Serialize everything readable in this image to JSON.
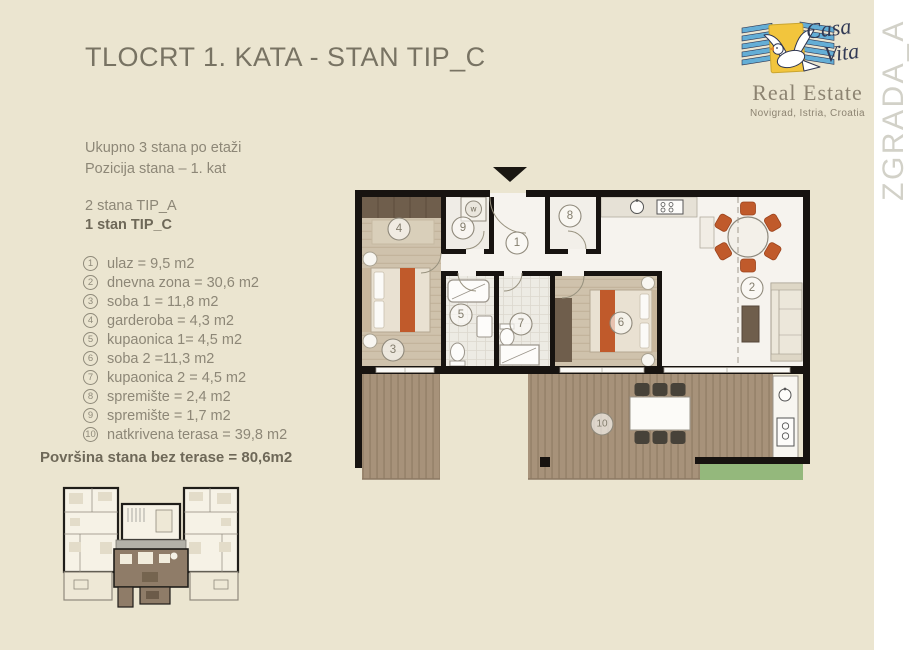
{
  "header": {
    "title": "TLOCRT 1. KATA - STAN TIP_C"
  },
  "side_label": {
    "text": "ZGRADA_A"
  },
  "logo": {
    "script1": "Casa",
    "script2": "Vita",
    "subtitle": "Real Estate",
    "location": "Novigrad, Istria, Croatia"
  },
  "info": {
    "total_per_floor": "Ukupno 3 stana po etaži",
    "position": "Pozicija stana – 1. kat",
    "type_a": "2 stana TIP_A",
    "type_c": "1 stan TIP_C"
  },
  "rooms": [
    {
      "num": "1",
      "label": "ulaz = 9,5 m2"
    },
    {
      "num": "2",
      "label": "dnevna zona = 30,6 m2"
    },
    {
      "num": "3",
      "label": "soba 1 = 11,8 m2"
    },
    {
      "num": "4",
      "label": "garderoba = 4,3 m2"
    },
    {
      "num": "5",
      "label": "kupaonica 1= 4,5 m2"
    },
    {
      "num": "6",
      "label": "soba 2 =11,3 m2"
    },
    {
      "num": "7",
      "label": "kupaonica 2 = 4,5 m2"
    },
    {
      "num": "8",
      "label": "spremište = 2,4 m2"
    },
    {
      "num": "9",
      "label": "spremište = 1,7 m2"
    },
    {
      "num": "10",
      "label": "natkrivena terasa = 39,8 m2"
    }
  ],
  "summary": {
    "area_text": "Površina stana bez terase = 80,6m2"
  },
  "floorplan": {
    "washer": "w"
  },
  "colors": {
    "background": "#ebe5d0",
    "accent_orange": "#c05a2b",
    "deck_wood": "#a7927a",
    "grass": "#94b87c",
    "wall": "#171310",
    "logo_blue": "#64aed6",
    "logo_yellow": "#f2c53d"
  }
}
